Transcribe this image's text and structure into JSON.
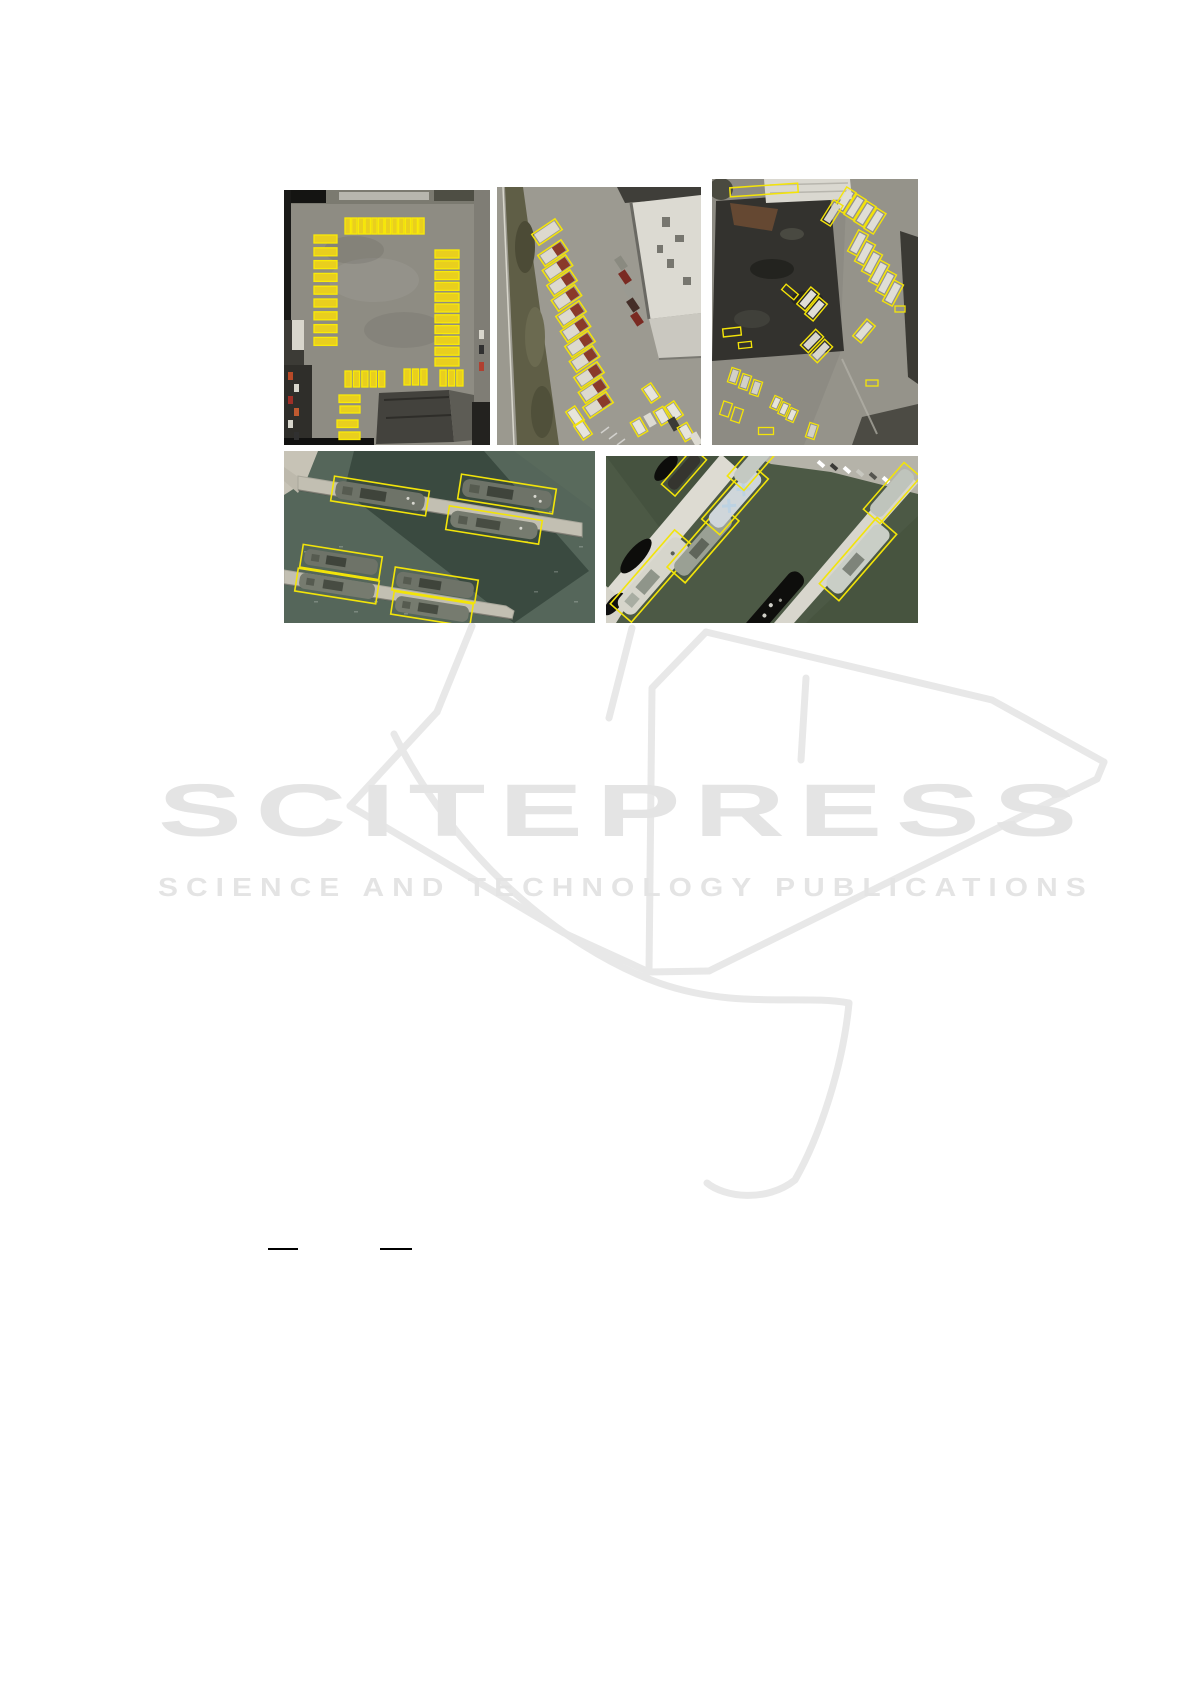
{
  "watermark": {
    "title": "SCITEPRESS",
    "subtitle": "SCIENCE AND TECHNOLOGY PUBLICATIONS",
    "text_color": "#e4e4e4",
    "book_outline_color": "#e8e8e8"
  },
  "figure": {
    "annotation_box_color": "#f4e408",
    "bus_color": "#e9cf1e",
    "panels": [
      {
        "id": "bus-depot"
      },
      {
        "id": "parking-lot-buses"
      },
      {
        "id": "rooftop-trucks"
      },
      {
        "id": "harbor-piers-ships"
      },
      {
        "id": "harbor-dock-ships"
      }
    ]
  },
  "rules": {
    "color": "#000000",
    "count": 2
  }
}
